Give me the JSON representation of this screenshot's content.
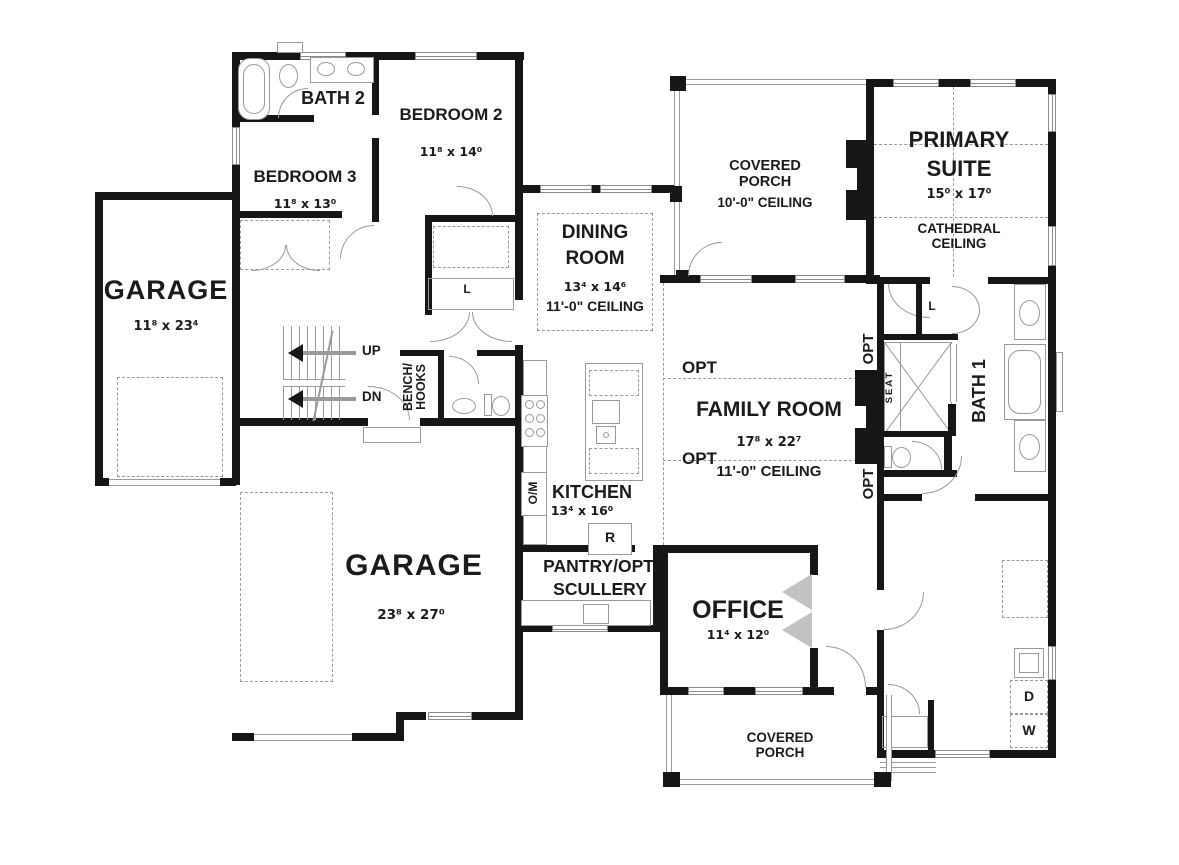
{
  "rooms": {
    "garage_left": {
      "name": "GARAGE",
      "dims": "11⁸ x 23⁴"
    },
    "garage_main": {
      "name": "GARAGE",
      "dims": "23⁸ x 27⁰"
    },
    "bath2": {
      "name": "BATH 2"
    },
    "bedroom2": {
      "name": "BEDROOM 2",
      "dims": "11⁸ x 14⁰"
    },
    "bedroom3": {
      "name": "BEDROOM 3",
      "dims": "11⁸ x 13⁰"
    },
    "dining": {
      "line1": "DINING",
      "line2": "ROOM",
      "dims": "13⁴ x 14⁶",
      "ceiling": "11'-0\" CEILING"
    },
    "covered_porch_top": {
      "line1": "COVERED",
      "line2": "PORCH",
      "ceiling": "10'-0\" CEILING"
    },
    "primary_suite": {
      "line1": "PRIMARY",
      "line2": "SUITE",
      "dims": "15⁰ x 17⁰",
      "ceiling1": "CATHEDRAL",
      "ceiling2": "CEILING"
    },
    "family": {
      "name": "FAMILY ROOM",
      "dims": "17⁸ x 22⁷",
      "ceiling": "11'-0\" CEILING"
    },
    "bath1": {
      "name": "BATH 1"
    },
    "kitchen": {
      "name": "KITCHEN",
      "dims": "13⁴ x 16⁰"
    },
    "pantry": {
      "line1": "PANTRY/OPT.",
      "line2": "SCULLERY"
    },
    "office": {
      "name": "OFFICE",
      "dims": "11⁴ x 12⁰"
    },
    "covered_porch_bottom": {
      "line1": "COVERED",
      "line2": "PORCH"
    }
  },
  "annotations": {
    "up": "UP",
    "dn": "DN",
    "bench1": "BENCH/",
    "bench2": "HOOKS",
    "om": "O/M",
    "fridge": "R",
    "linen": "L",
    "seat": "SEAT",
    "opt": "OPT",
    "dryer": "D",
    "washer": "W"
  },
  "colors": {
    "wall": "#161616",
    "line": "#9a9a9a",
    "text": "#1b1b1b",
    "bg": "#ffffff"
  }
}
